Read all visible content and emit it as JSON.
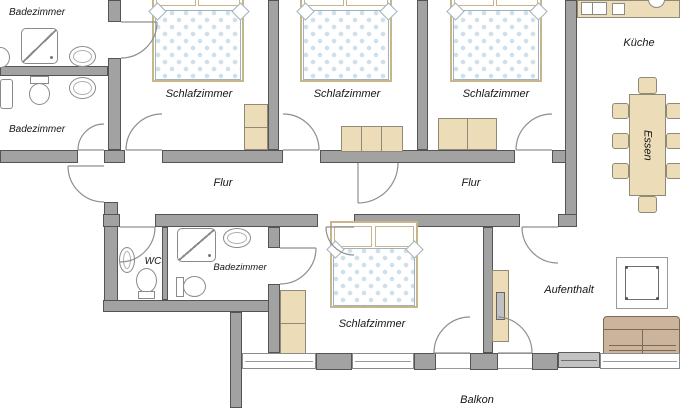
{
  "rooms": {
    "badezimmer_top": {
      "label": "Badezimmer"
    },
    "badezimmer_left": {
      "label": "Badezimmer"
    },
    "schlafzimmer_1": {
      "label": "Schlafzimmer"
    },
    "schlafzimmer_2": {
      "label": "Schlafzimmer"
    },
    "schlafzimmer_3": {
      "label": "Schlafzimmer"
    },
    "kueche": {
      "label": "Küche"
    },
    "essen": {
      "label": "Essen"
    },
    "flur_west": {
      "label": "Flur"
    },
    "flur_east": {
      "label": "Flur"
    },
    "wc": {
      "label": "WC"
    },
    "badezimmer_bottom": {
      "label": "Badezimmer"
    },
    "schlafzimmer_4": {
      "label": "Schlafzimmer"
    },
    "aufenthalt": {
      "label": "Aufenthalt"
    },
    "balkon": {
      "label": "Balkon"
    }
  },
  "colors": {
    "wall": "#a2a2a2",
    "wall_edge": "#545454",
    "furniture": "#ecdcb8",
    "furniture_edge": "#8f8a75",
    "bed_frame": "#c7b68c",
    "bed_dots": "#cfe0ea",
    "sofa": "#cbb49b",
    "floor": "#ffffff",
    "text": "#161616"
  },
  "fixtures": [
    "bed",
    "pillow",
    "wardrobe",
    "bench",
    "shower",
    "sink",
    "toilet",
    "kitchen-counter",
    "dining-table",
    "chair",
    "square-table",
    "sofa",
    "radiator",
    "window",
    "door-swing"
  ]
}
